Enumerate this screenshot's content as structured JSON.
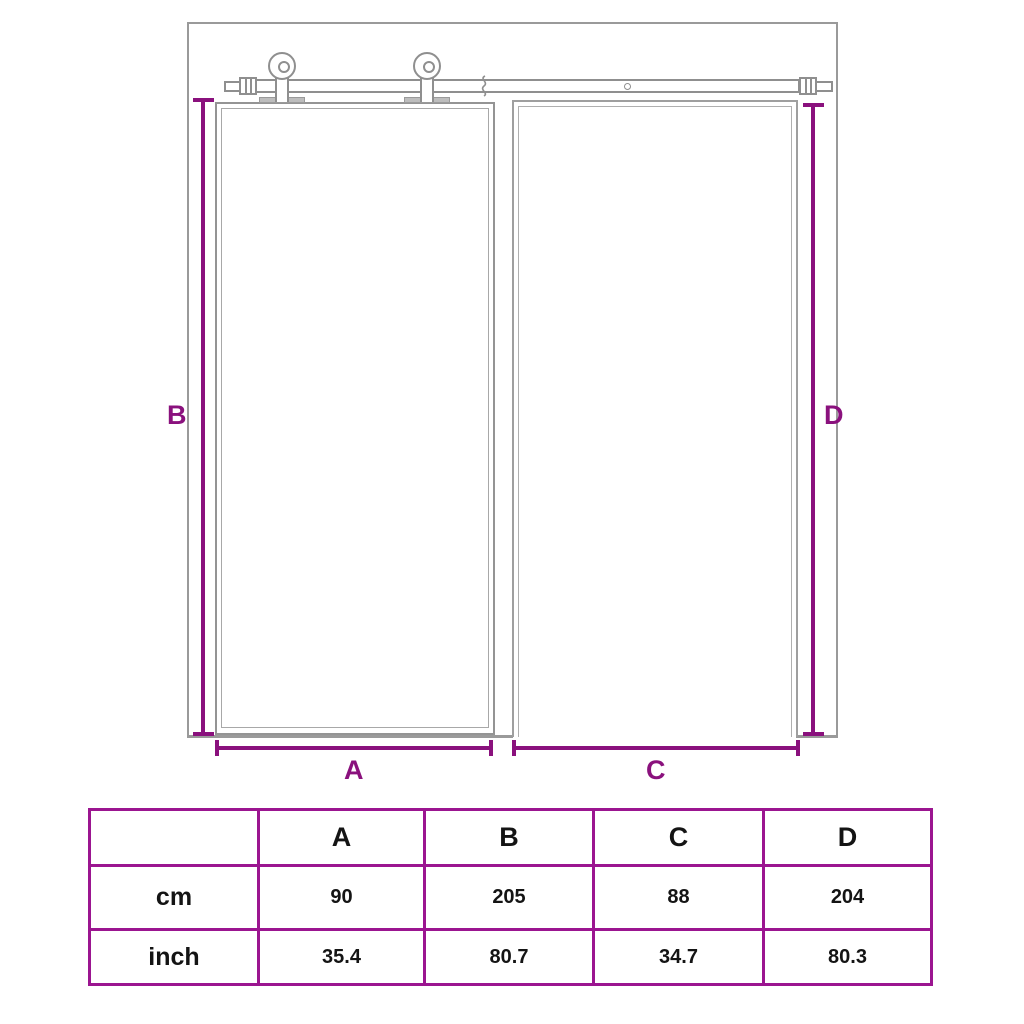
{
  "diagram": {
    "type": "sliding-barn-door-dimension-diagram",
    "labels": {
      "A": "A",
      "B": "B",
      "C": "C",
      "D": "D"
    },
    "parts": [
      "wall",
      "door-panel",
      "door-opening",
      "rail",
      "roller-left",
      "roller-right"
    ],
    "colors": {
      "drawing_line": "#8f8f8f",
      "dimension_purple": "#8a117d",
      "table_border_purple": "#9b1590",
      "table_text": "#141414",
      "background": "#ffffff"
    }
  },
  "table": {
    "columns": [
      "",
      "A",
      "B",
      "C",
      "D"
    ],
    "rows": [
      {
        "label": "cm",
        "values": [
          "90",
          "205",
          "88",
          "204"
        ]
      },
      {
        "label": "inch",
        "values": [
          "35.4",
          "80.7",
          "34.7",
          "80.3"
        ]
      }
    ]
  }
}
